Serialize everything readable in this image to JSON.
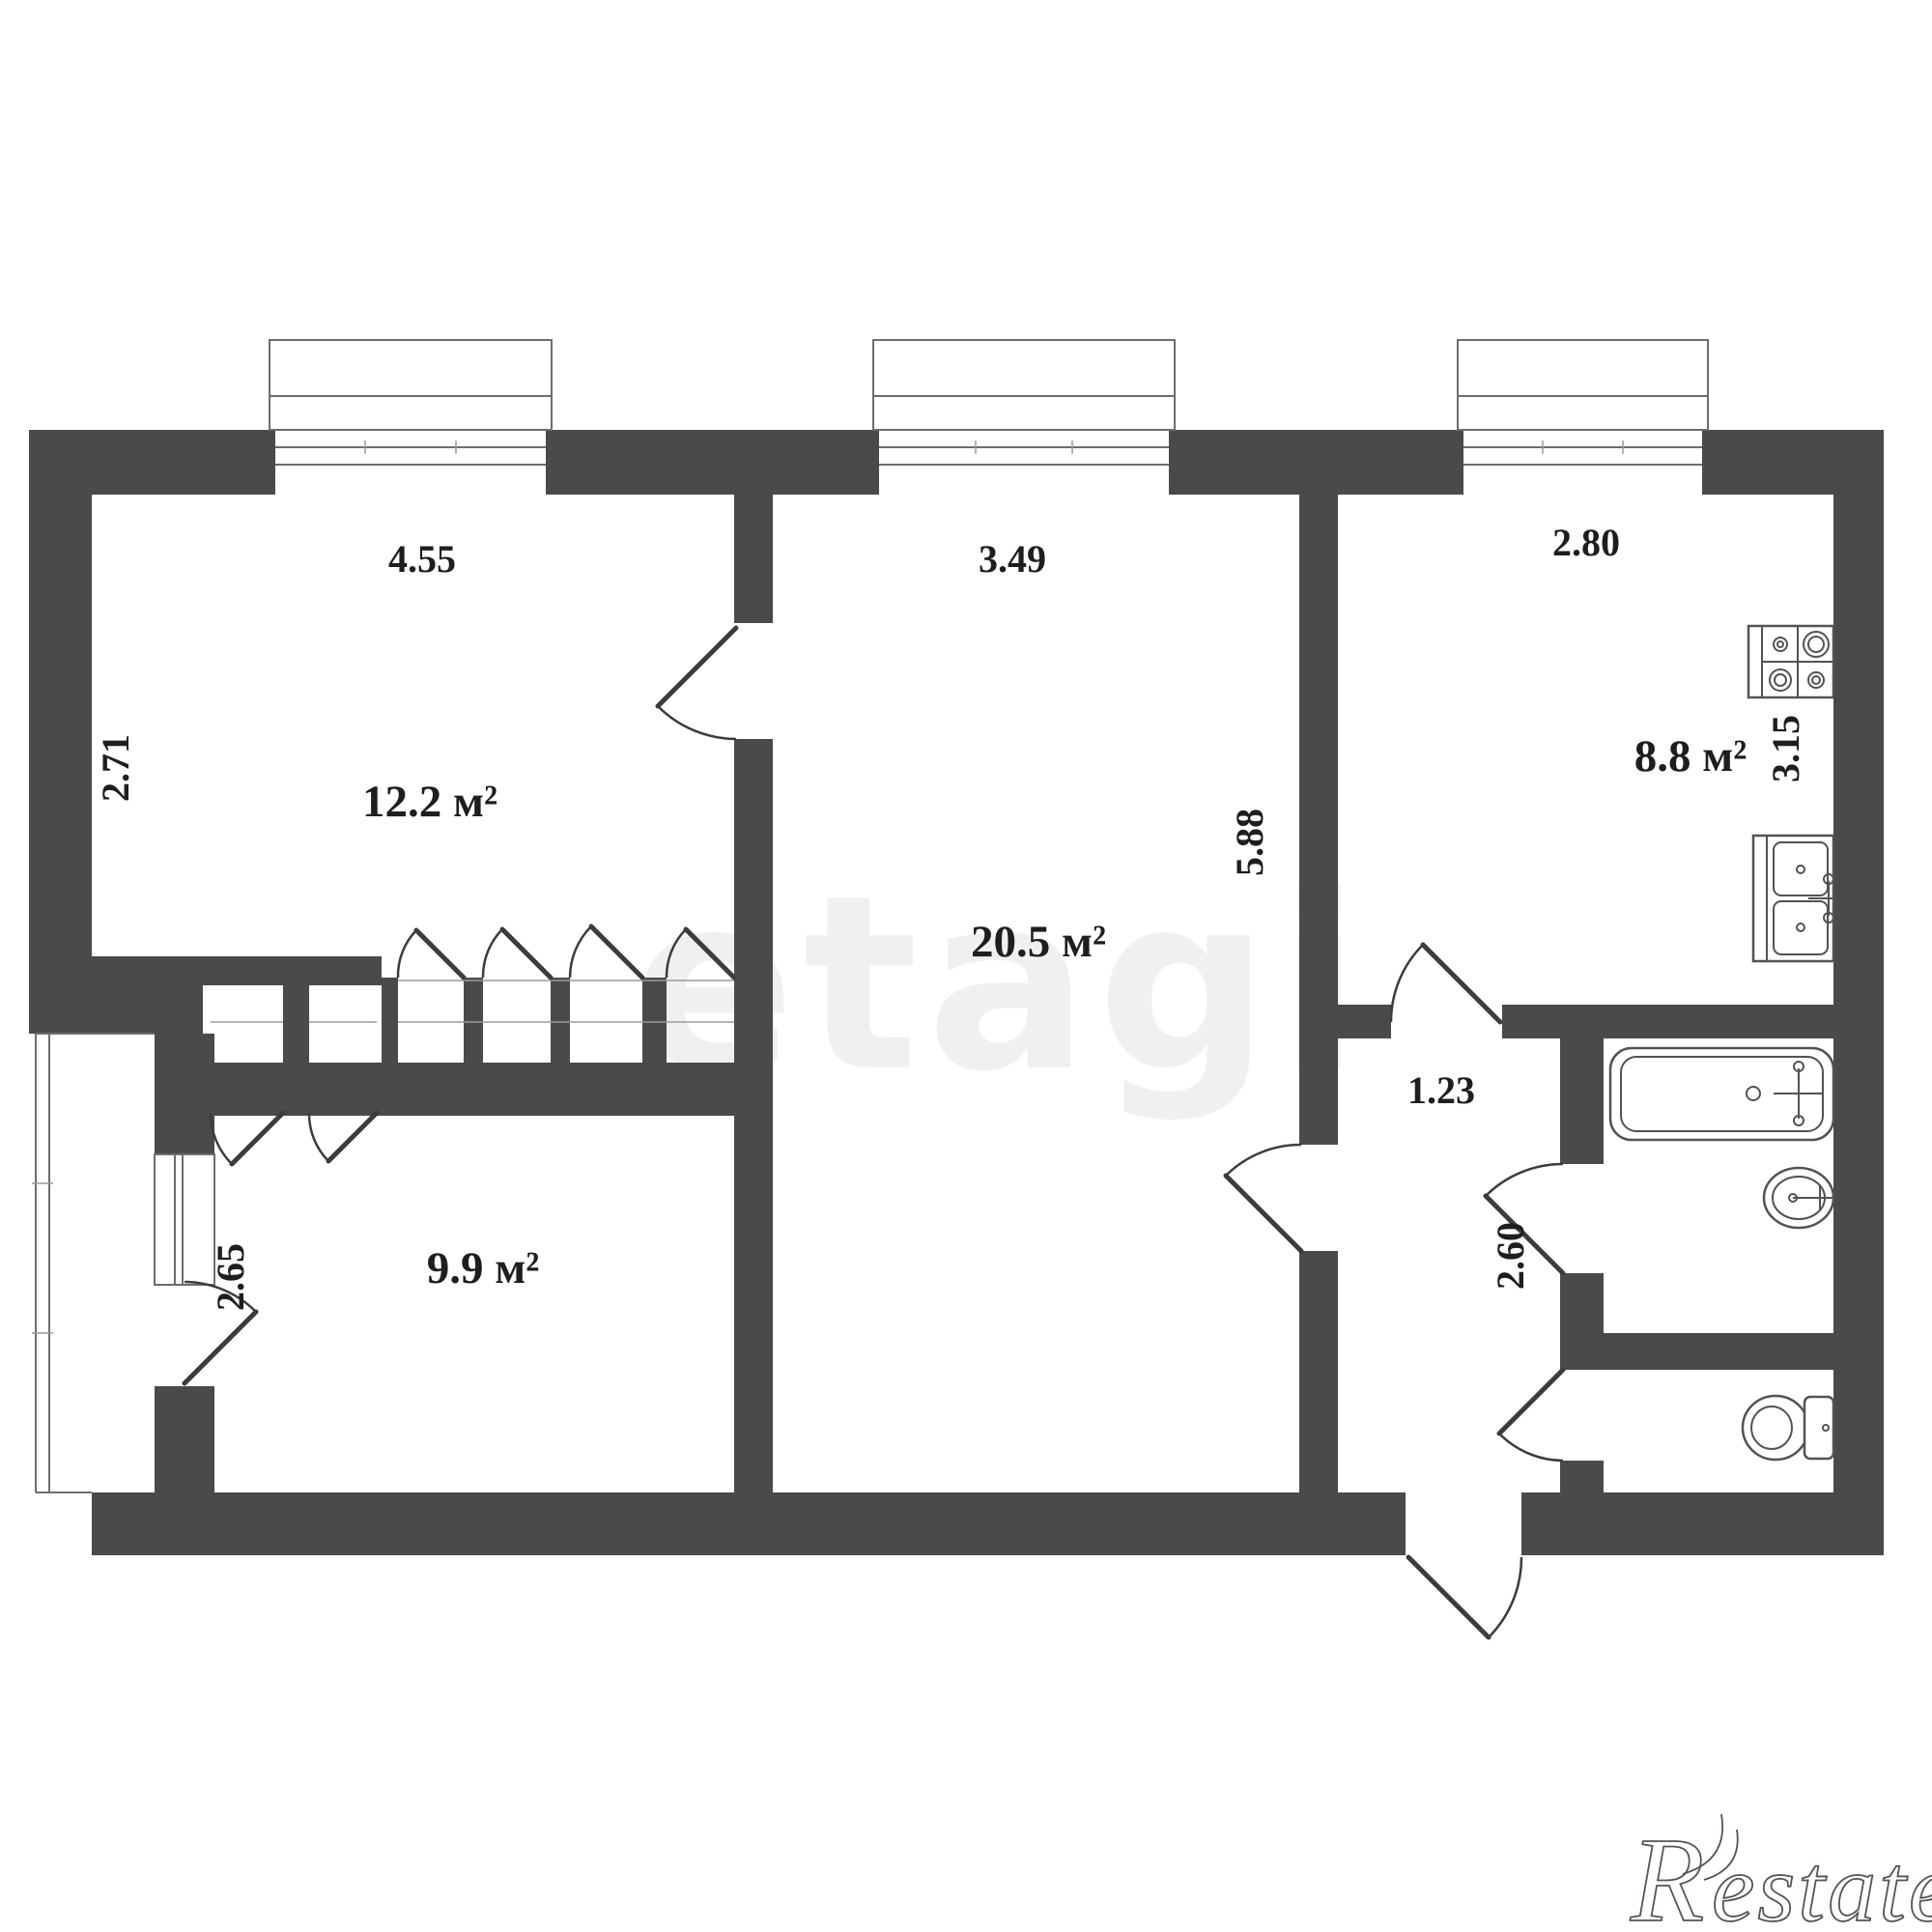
{
  "plan": {
    "type": "apartment-floor-plan",
    "rooms": {
      "bedroom1": {
        "name": "room-12-2",
        "area": "12.2 м²",
        "width": "4.55",
        "height": "2.71"
      },
      "living": {
        "name": "room-20-5",
        "area": "20.5 м²",
        "width": "3.49",
        "height": "5.88"
      },
      "kitchen": {
        "name": "kitchen-8-8",
        "area": "8.8 м²",
        "width": "2.80",
        "height": "3.15"
      },
      "bedroom2": {
        "name": "room-9-9",
        "area": "9.9 м²",
        "height": "2.65"
      },
      "corridor": {
        "name": "hallway",
        "width": "1.23",
        "height": "2.60"
      }
    },
    "fixtures": [
      "stove-icon",
      "kitchen-sink-icon",
      "bathtub-icon",
      "bathroom-sink-icon",
      "toilet-icon"
    ],
    "features": [
      "balcony",
      "built-in-closets",
      "entry-door"
    ],
    "colors": {
      "wall": "#4a4a49",
      "background": "#ffffff",
      "text": "#1e1e1e",
      "logo": "#5a5150"
    }
  },
  "watermark": {
    "brand": "etagi",
    "logo_r": "R",
    "logo_rest": "estate"
  }
}
